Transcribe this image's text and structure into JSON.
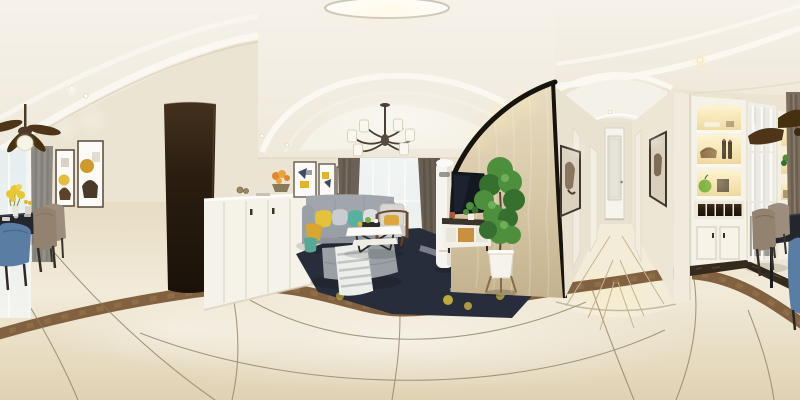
{
  "meta": {
    "title": "360-degree panoramic render of a modern cream-toned apartment interior: dining area, living room with sofa and TV wall, hallway and lit display cabinets",
    "type": "equirectangular-panorama",
    "width_px": 800,
    "height_px": 400
  },
  "palette": {
    "wall": "#ece4d2",
    "ceil": "#f2eee4",
    "ceilBand": "#faf8f1",
    "floorHi": "#f2ebd9",
    "floorLo": "#e0d2b3",
    "marbleBrown": "#7b5a38",
    "grout": "#8d7c5e",
    "doorDark": "#241a10",
    "cabWhite": "#f5f2ea",
    "sofa": "#a0a6ac",
    "sofaDeep": "#8d939a",
    "pillowYellow": "#e5c23c",
    "pillowTeal": "#57b0a0",
    "throwMustard": "#d9a62f",
    "throwTeal": "#58a896",
    "rug": "#272d3a",
    "rugYellow": "#d8c13e",
    "curtainGray": "#8d8a84",
    "drape": "#6b6156",
    "curtainTaupe": "#7d6f5f",
    "fanWood": "#4e3419",
    "armWood": "#6b4c30",
    "drawerWood": "#c8903f",
    "tv": "#141921",
    "trim": "#17130d",
    "paper": "#d3c5a6",
    "paperHi": "#e9dcc0",
    "plant": "#4e8f3e",
    "plantDeep": "#376f2f",
    "chairTaupe": "#93826f",
    "chairBlue": "#5a7da3",
    "tableDark": "#23262c",
    "artGold": "#e0b52b",
    "artNavy": "#3d4a63",
    "flower": "#e8c832",
    "flowerOrange": "#e0862e",
    "niche": "#f6e5b4",
    "apple": "#7ab03c",
    "lampGlow": "#fff3d0",
    "potWhite": "#f5f3ec"
  },
  "scene": {
    "areas": [
      {
        "id": "dining",
        "label": "Dining area with ceiling fan, two framed artworks, dark table, blue and taupe chairs and yellow flowers"
      },
      {
        "id": "divider",
        "label": "Dark open doorway and white half-wall divider cabinet with books and orange flowers"
      },
      {
        "id": "living",
        "label": "Living room with three framed artworks, gray sofa, chandelier, sheer balcony window, armchair, coffee table, ottoman and dark patterned rug"
      },
      {
        "id": "tv-wall",
        "label": "Beige wallpaper TV wall with black curved trim, wall-mounted TV, media cabinet, floor air conditioner and tall potted plant"
      },
      {
        "id": "hallway",
        "label": "Hallway with recessed spotlights, framed art on both walls and white frosted-glass door"
      },
      {
        "id": "kitchen",
        "label": "Warm-lit display cabinets with wine bottles and wine rack, glass partition, taupe curtain and second dining corner"
      }
    ],
    "objects": [
      "ceiling-fan",
      "ceiling-flush-light",
      "recessed-spotlight",
      "chandelier",
      "gray-curtain",
      "sheer-window",
      "framed-artwork",
      "dining-table",
      "blue-dining-chair",
      "taupe-dining-chair",
      "yellow-flower-vase",
      "dark-doorway",
      "divider-cabinet",
      "book-stack",
      "orange-flower-bowl",
      "gray-sofa",
      "yellow-pillow",
      "teal-pillow",
      "mustard-throw",
      "teal-throw",
      "white-coffee-table",
      "ottoman",
      "striped-blanket",
      "area-rug",
      "wood-frame-armchair",
      "sphere-table-lamp",
      "floor-air-conditioner",
      "wall-tv",
      "tv-media-cabinet",
      "potted-fiddle-leaf-plant",
      "hallway-door",
      "display-shelf-unit",
      "wine-bottles",
      "wine-rack",
      "green-apple-decor",
      "glass-partition",
      "taupe-curtain",
      "marble-floor-border",
      "cream-marble-floor"
    ]
  }
}
